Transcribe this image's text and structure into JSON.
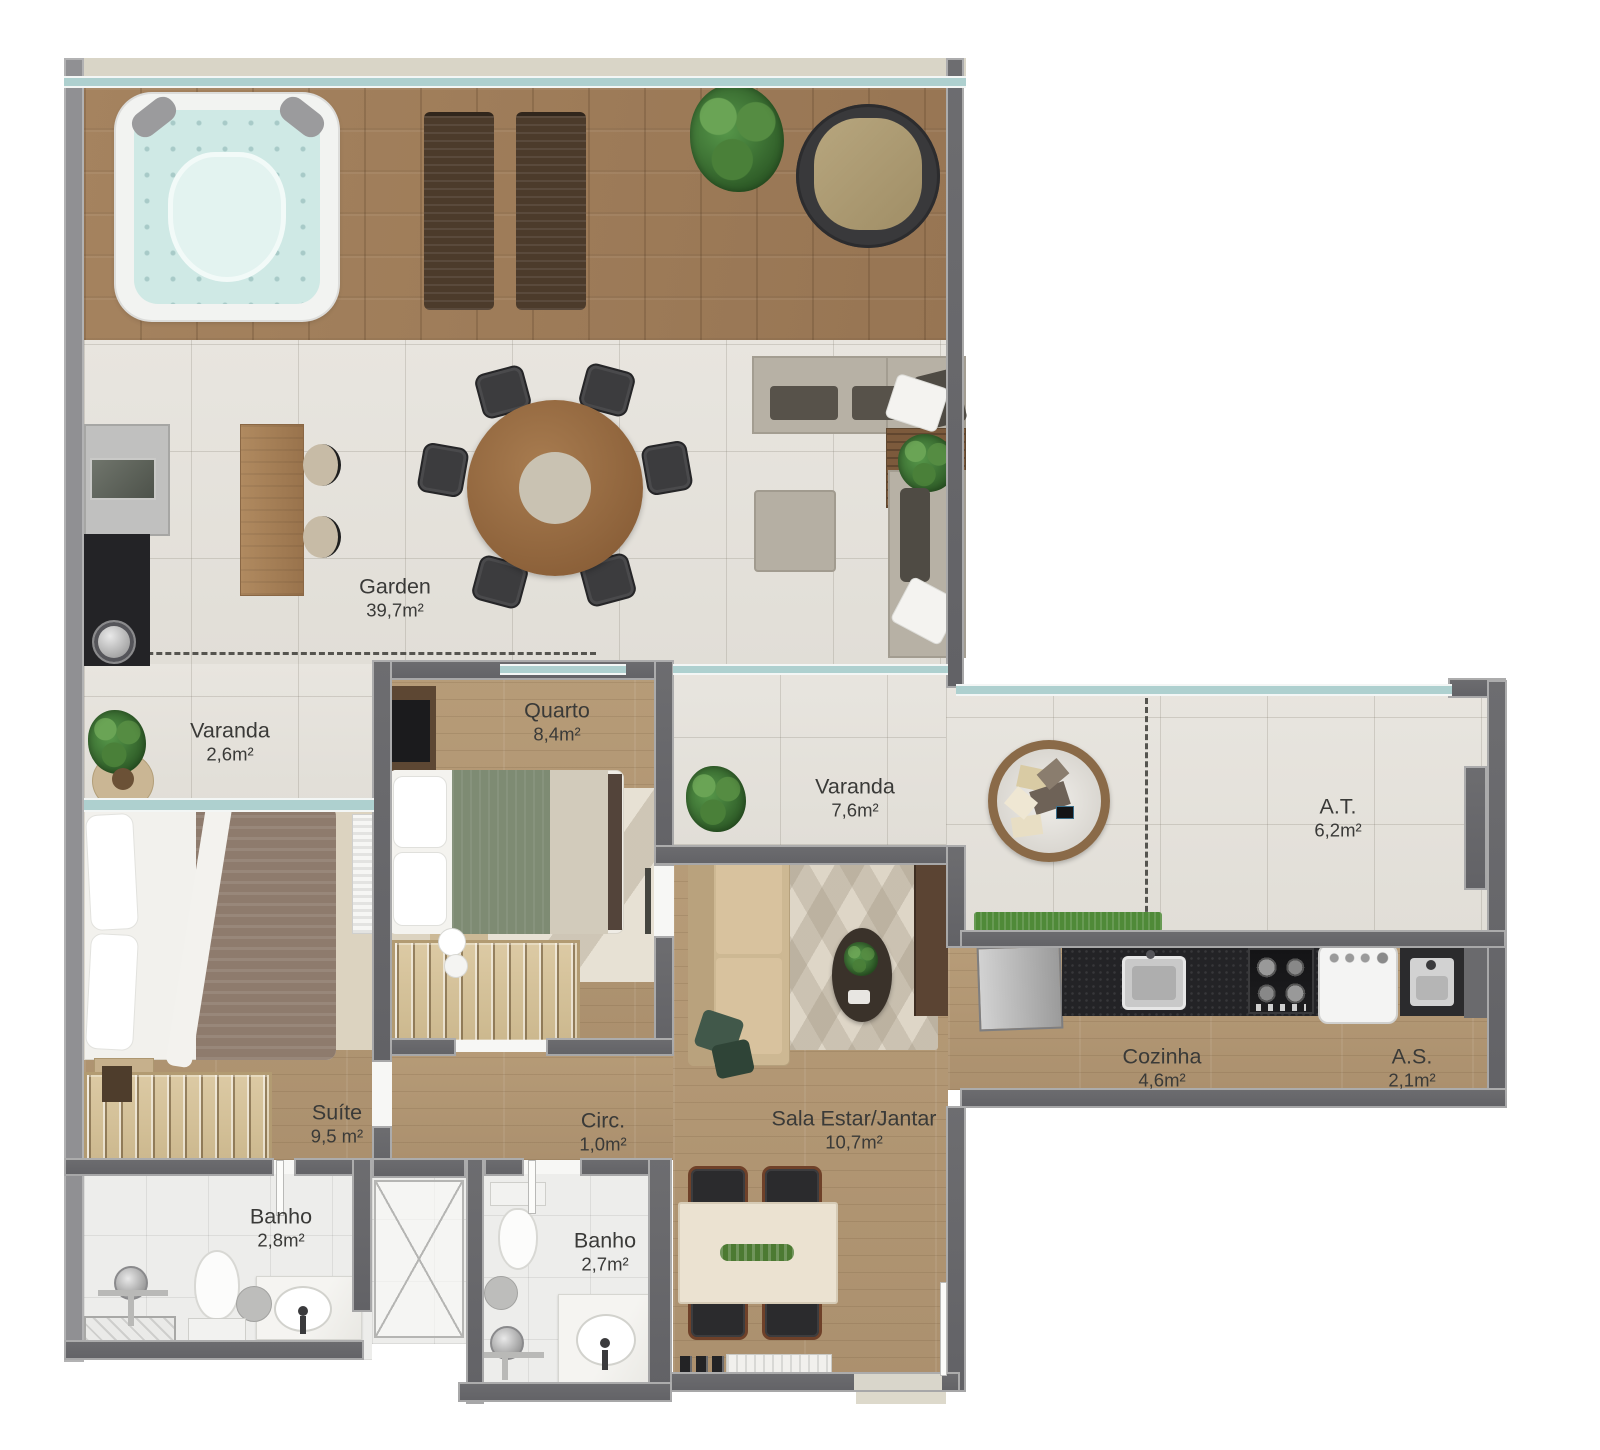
{
  "title": "Apartment floor plan (penthouse with garden terrace)",
  "palette": {
    "wall_dark": "#67676b",
    "wall_light": "#909093",
    "glass_line": "#aed0cf",
    "deck_wood": "#a0805c",
    "interior_wood": "#b49a77",
    "stone_floor": "#e7e4de",
    "bath_tile": "#ededeb",
    "counter_black": "#232326",
    "grass_green": "#4f8a38",
    "label_text": "#3a3a38"
  },
  "plan": {
    "rooms": [
      {
        "id": "garden",
        "name": "Garden",
        "area": "39,7m²"
      },
      {
        "id": "varanda-garden",
        "name": "Varanda",
        "area": "2,6m²"
      },
      {
        "id": "quarto",
        "name": "Quarto",
        "area": "8,4m²"
      },
      {
        "id": "varanda",
        "name": "Varanda",
        "area": "7,6m²"
      },
      {
        "id": "area-tecnica",
        "name": "A.T.",
        "area": "6,2m²"
      },
      {
        "id": "suite",
        "name": "Suíte",
        "area": "9,5 m²"
      },
      {
        "id": "circulacao",
        "name": "Circ.",
        "area": "1,0m²"
      },
      {
        "id": "sala",
        "name": "Sala Estar/Jantar",
        "area": "10,7m²"
      },
      {
        "id": "cozinha",
        "name": "Cozinha",
        "area": "4,6m²"
      },
      {
        "id": "area-servico",
        "name": "A.S.",
        "area": "2,1m²"
      },
      {
        "id": "banho-1",
        "name": "Banho",
        "area": "2,8m²"
      },
      {
        "id": "banho-2",
        "name": "Banho",
        "area": "2,7m²"
      }
    ]
  }
}
